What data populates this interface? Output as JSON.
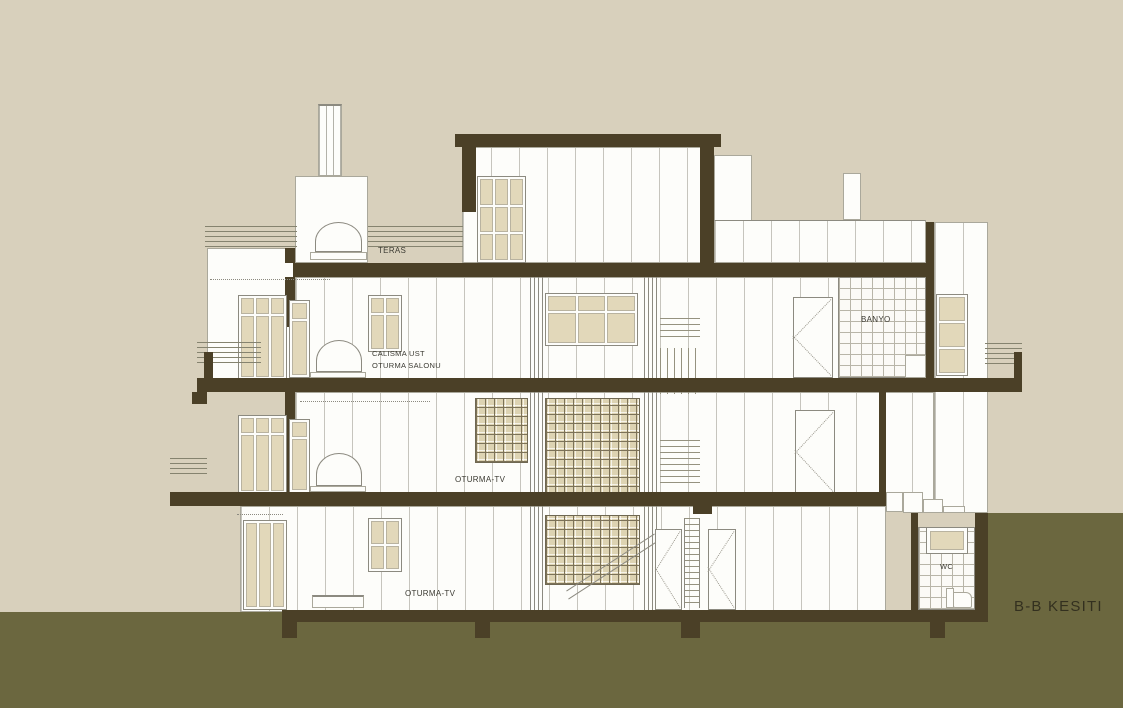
{
  "title": "B-B KESITI",
  "labels": {
    "teras": "TERAS",
    "calisma_line1": "CALISMA UST",
    "calisma_line2": "OTURMA SALONU",
    "banyo": "BANYO",
    "oturma_tv_first_floor": "OTURMA-TV",
    "oturma_tv_ground_floor": "OTURMA-TV",
    "wc": "WC"
  },
  "colors": {
    "background": "#d8d0bc",
    "ground": "#6b673f",
    "section_cut": "#4b4027",
    "wall_white": "#fdfdfa",
    "line": "#8c8a80",
    "glass": "#e2d8ba",
    "label_text": "#3c3b33",
    "title_text": "#33301f"
  }
}
